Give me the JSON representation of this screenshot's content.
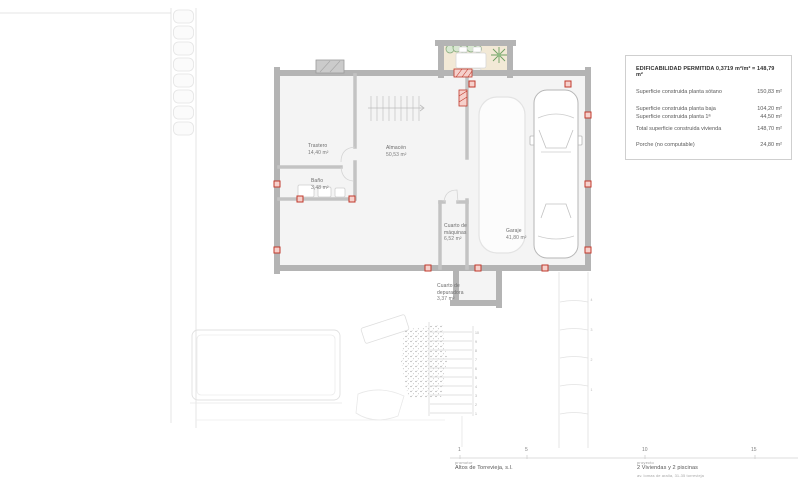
{
  "sheet": {
    "info_box": {
      "title": "EDIFICABILIDAD PERMITIDA 0,3719 m²/m² = 148,79 m²",
      "rows": [
        {
          "label": "Superficie construida planta sótano",
          "value": "150,83 m²"
        },
        {
          "label": "Superficie construida planta baja",
          "value": "104,20 m²"
        },
        {
          "label": "Superficie construida planta 1ª",
          "value": "44,50 m²"
        },
        {
          "label": "Total superficie construida vivienda",
          "value": "148,70 m²"
        },
        {
          "label": "Porche (no computable)",
          "value": "24,80 m²"
        }
      ]
    },
    "rooms": [
      {
        "name": "Trastero",
        "area": "14,40 m²"
      },
      {
        "name": "Almacén",
        "area": "50,53 m²"
      },
      {
        "name": "Baño",
        "area": "3,48 m²"
      },
      {
        "name": "Cuarto de máquinas",
        "area": "6,52 m²"
      },
      {
        "name": "Garaje",
        "area": "41,80 m²"
      },
      {
        "name": "Cuarto de depuradora",
        "area": "3,37 m²"
      }
    ],
    "scale_bar": {
      "ticks": [
        "1",
        "5",
        "10",
        "15"
      ]
    },
    "title_block": {
      "promoter_label": "promotor",
      "promoter": "Altos de Torrevieja, s.l.",
      "project_label": "proyecto",
      "project": "2 Viviendas y 2 piscinas",
      "project_address": "av. lomas de aralia, 31-35 torrevieja"
    },
    "colors": {
      "accent_red": "#c0392b",
      "wall_gray": "#b5b5b5",
      "courtyard_beige": "#f2e9d6",
      "plant_green": "#7aa86f"
    }
  }
}
